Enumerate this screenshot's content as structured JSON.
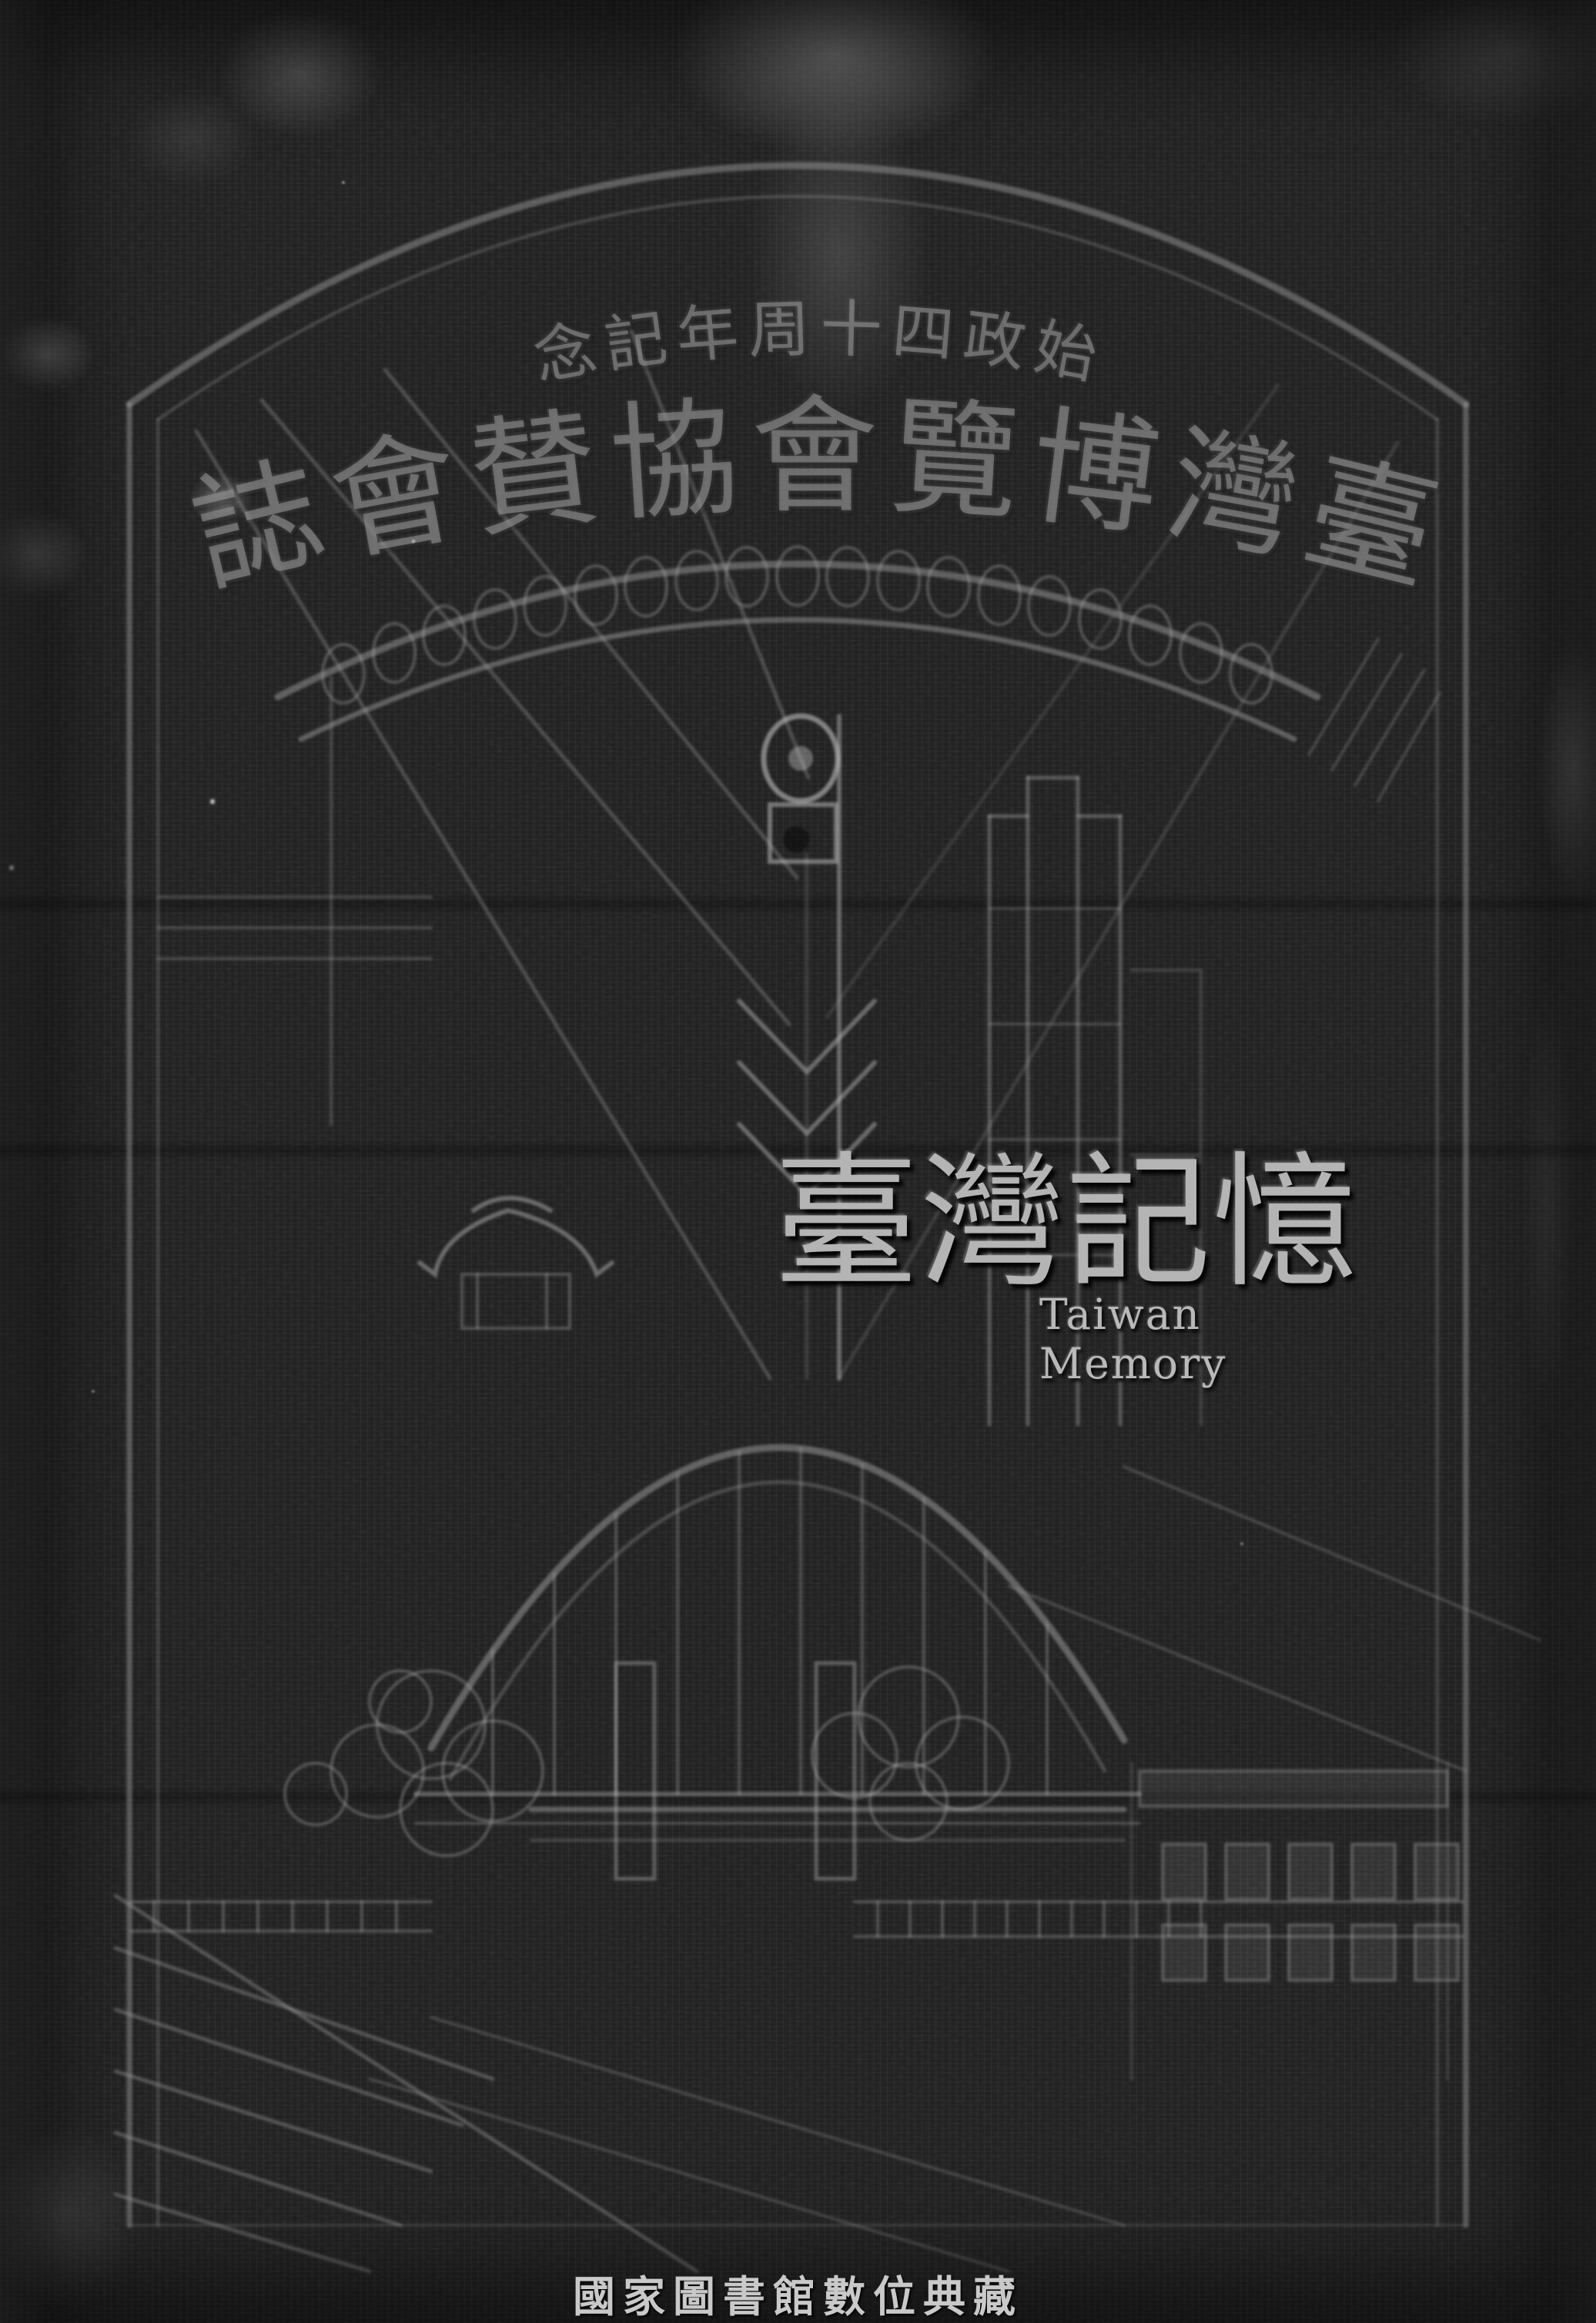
{
  "scan": {
    "kind": "digitized-book-cover",
    "colors": {
      "cover_background": "#212121",
      "emboss_line": "#9a9a9a",
      "emboss_title": "#8a8a8a",
      "watermark": "#b4b4b4",
      "footer_caption": "#c9c9c9"
    }
  },
  "cover": {
    "series_caption": {
      "text": "始政四十周年記念",
      "display_rtl": "念記年周十四政始"
    },
    "title": {
      "text": "臺灣博覽會協賛會誌",
      "display_rtl": "誌會賛協會覽博灣臺"
    },
    "illustration_motifs": "arch-gate, ring-band, light-tower, suspension-bridge, temple-roof, exhibition-buildings, trees, stairway"
  },
  "watermark": {
    "cjk": "臺灣記憶",
    "latin": "Taiwan Memory"
  },
  "footer": {
    "caption": "國家圖書館數位典藏"
  }
}
